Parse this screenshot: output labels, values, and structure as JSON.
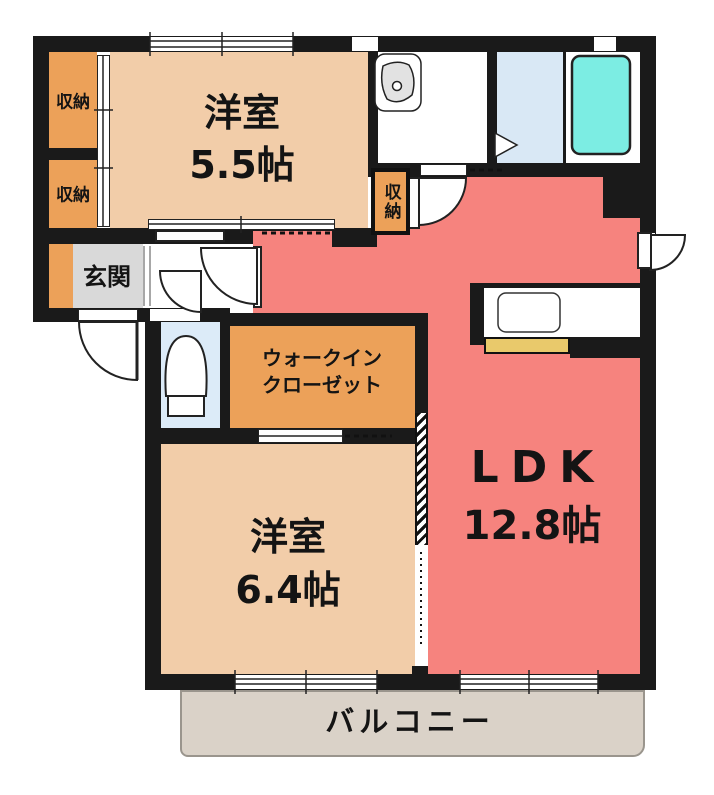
{
  "plan_title": "2LDK apartment floor plan",
  "colors": {
    "wall": "#1a1a1a",
    "bedroom": "#F2CDA9",
    "ldk": "#F6837E",
    "storage": "#ECA159",
    "entrance_gray": "#D9D9D9",
    "toilet_blue": "#DCEBF8",
    "changing_blue": "#D9E8F5",
    "tub_cyan": "#7CEDE3",
    "balcony": "#DAD2C8",
    "counter_yellow": "#E9C96B"
  },
  "rooms": {
    "bedroom1": {
      "name": "洋室",
      "size": "5.5帖"
    },
    "bedroom2": {
      "name": "洋室",
      "size": "6.4帖"
    },
    "ldk": {
      "name": "LDK",
      "size": "12.8帖"
    },
    "walk_in_closet": {
      "line1": "ウォークイン",
      "line2": "クローゼット"
    },
    "entrance": {
      "label": "玄関"
    },
    "balcony": {
      "label": "バルコニー"
    },
    "storage_top": {
      "label": "収納"
    },
    "storage_mid": {
      "label": "収納"
    },
    "storage_hall": {
      "label": "収納"
    }
  }
}
